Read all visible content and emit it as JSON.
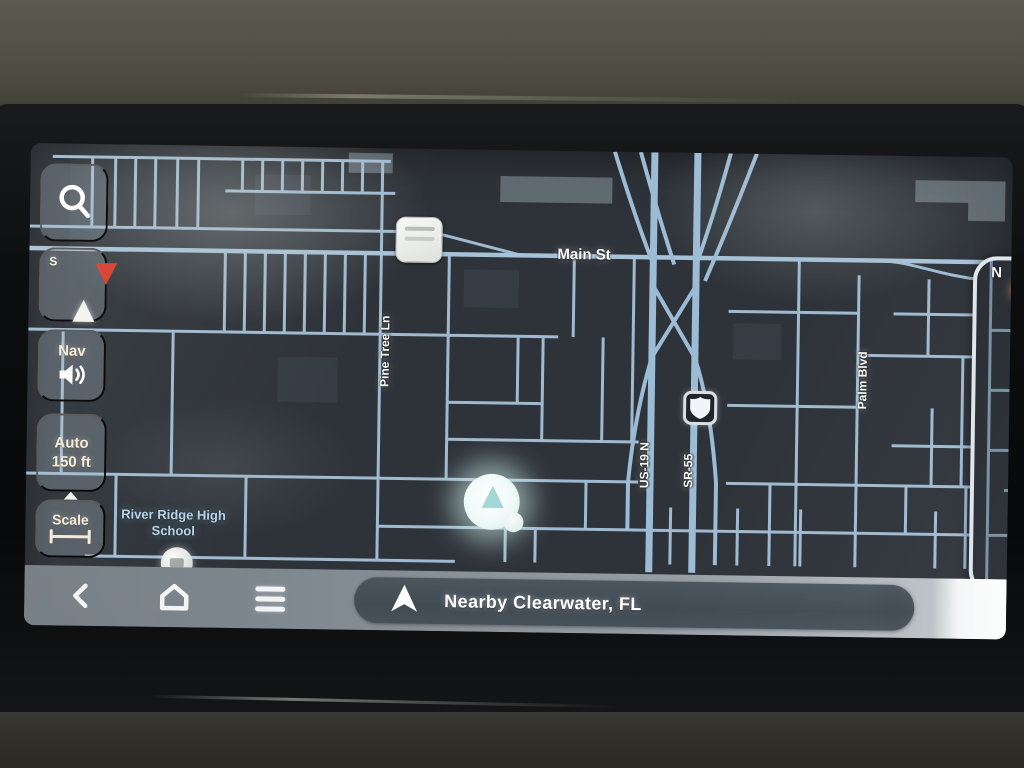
{
  "theme": {
    "map_bg": "#2e3339",
    "road": "#a6c2d8",
    "road_major": "#9cbcd6",
    "label_blue": "#b9d4e8",
    "accent_red": "#d63e2e",
    "button_bg": "rgba(173,188,201,0.30)",
    "button_text": "#f3ecd9",
    "pill_bg": "#47515b"
  },
  "sidebar": {
    "compass_label": "S",
    "nav_label": "Nav",
    "zoom_line1": "Auto",
    "zoom_line2": "150 ft",
    "scale_label": "Scale"
  },
  "map": {
    "labels": {
      "main_st": "Main St",
      "pine_tree": "Pine Tree Ln",
      "us19": "US-19 N",
      "sr55": "SR-55",
      "palm_blvd": "Palm Blvd",
      "school": "River Ridge High School"
    }
  },
  "minimap": {
    "north_label": "N"
  },
  "bottom_bar": {
    "status_text": "Nearby Clearwater, FL"
  }
}
